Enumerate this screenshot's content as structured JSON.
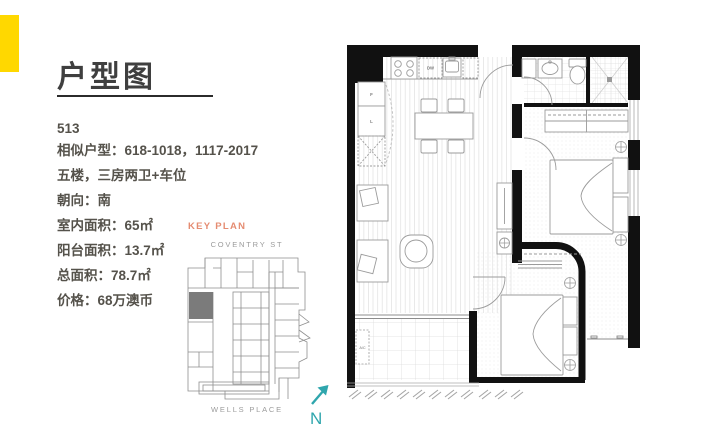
{
  "slide": {
    "title": "户型图"
  },
  "unit": {
    "number": "513",
    "details": [
      "相似户型：618-1018，1117-2017",
      "五楼，三房两卫+车位",
      "朝向：南",
      "室内面积：65㎡",
      "阳台面积：13.7㎡",
      "总面积：78.7㎡",
      "价格：68万澳币"
    ]
  },
  "key_plan": {
    "label": "KEY PLAN",
    "street_top": "COVENTRY ST",
    "street_bottom": "WELLS PLACE",
    "compass_letter": "N"
  },
  "floor_plan_labels": {
    "fridge": "F",
    "linen": "L",
    "dishwasher": "DW",
    "air_conditioner": "A/C"
  },
  "colors": {
    "accent_yellow": "#FFD800",
    "key_plan_label": "#E58C72",
    "compass_teal": "#2FA6AD",
    "title_text": "#3F3F3F",
    "body_text": "#55524B",
    "street_text": "#9B9B9B",
    "wall_black": "#111111",
    "unit_highlight_gray": "#7B7B7B"
  }
}
